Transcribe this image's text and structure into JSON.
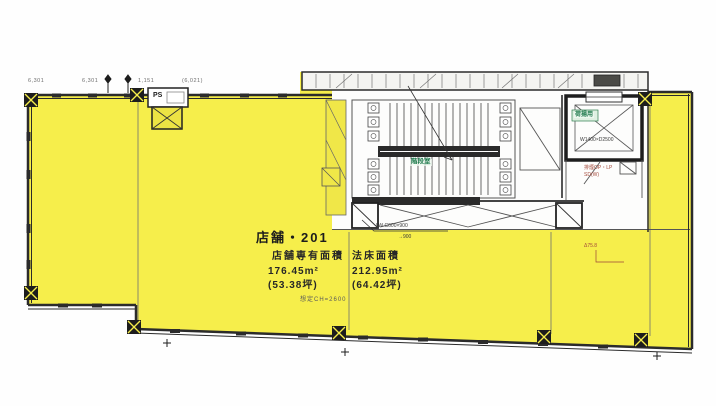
{
  "plan": {
    "title": "店舗・201",
    "exclusive": {
      "label": "店舗専有面積",
      "m2": "176.45m²",
      "tsubo": "(53.38坪)"
    },
    "legal": {
      "label": "法床面積",
      "m2": "212.95m²",
      "tsubo": "(64.42坪)"
    },
    "ceiling_note": "想定CH=2600",
    "rooms": {
      "ps": "PS",
      "stair": "階段室",
      "elevator": "荷揚用"
    },
    "annotations": {
      "elevator_size": "W1400×D2500",
      "smoke1": "排煙OP・LP",
      "smoke2": "SD(W)",
      "level": "Δ75.8",
      "beam": "LW C600×900",
      "beam2": "→900"
    },
    "dimensions": {
      "d1": "6,301",
      "d2": "6,301",
      "d3": "1,151",
      "d4": "(6,021)"
    }
  },
  "colors": {
    "highlight": "#f6ee4b",
    "wall": "#2b2b2b",
    "thin_line": "#6e6e6e",
    "green_text": "#1f7a4d",
    "red_text": "#a3493a",
    "core_bg": "#fdfdfc"
  }
}
